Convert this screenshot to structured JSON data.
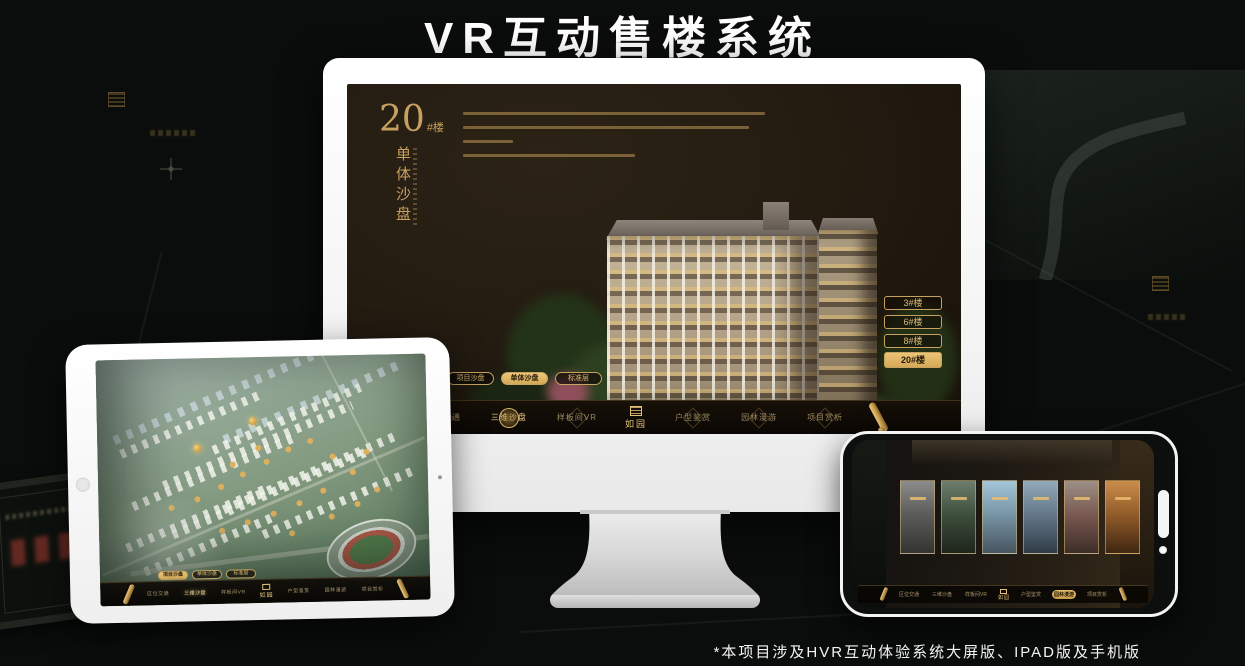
{
  "page": {
    "title": "VR互动售楼系统",
    "footnote": "*本项目涉及HVR互动体验系统大屏版、IPAD版及手机版"
  },
  "colors": {
    "gold": "#C9A15E",
    "gold_active": "#E8C170",
    "screen_bg": "#221A10",
    "nav_bg": "#0D0905",
    "title_text": "#FFFFFF"
  },
  "shared_nav": {
    "logo": "如园",
    "items": [
      "区位交通",
      "三维沙盘",
      "样板间VR",
      "户型鉴赏",
      "园林漫游",
      "项目赏析"
    ]
  },
  "view_tabs": [
    "项目沙盘",
    "单体沙盘",
    "标准层"
  ],
  "desktop": {
    "heading": {
      "number": "20",
      "suffix": "#楼",
      "subtitle_vertical": "单体沙盘"
    },
    "building_buttons": [
      {
        "label": "3#楼",
        "active": false
      },
      {
        "label": "6#楼",
        "active": false
      },
      {
        "label": "8#楼",
        "active": false
      },
      {
        "label": "20#楼",
        "active": true
      }
    ],
    "active_tab": "单体沙盘",
    "active_nav_item": "三维沙盘"
  },
  "tablet": {
    "active_tab": "项目沙盘",
    "active_nav_item": "三维沙盘"
  },
  "phone": {
    "active_nav_item": "园林漫游",
    "gallery_card_count": 6
  }
}
